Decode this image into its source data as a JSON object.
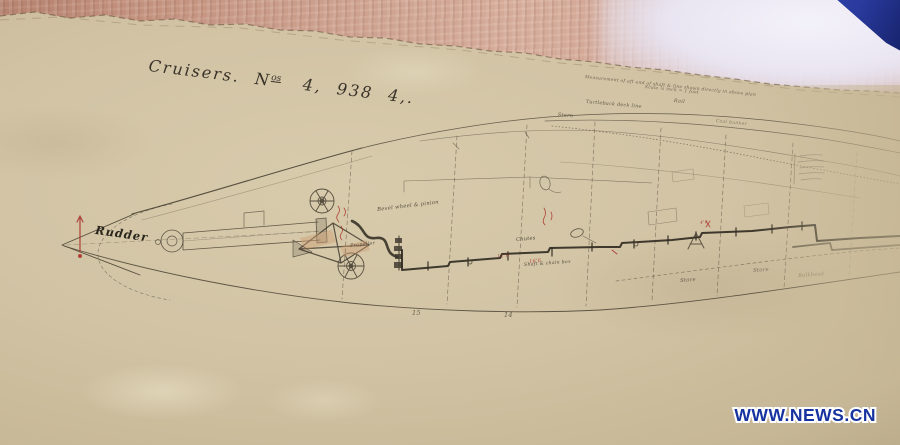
{
  "photo": {
    "watermark": "WWW.NEWS.CN"
  },
  "colors": {
    "paper": "#d1c3a4",
    "wood": "#cc9f8d",
    "ink": "#4a4234",
    "red_ink": "#a8352c",
    "watermark_blue": "#1733a0"
  },
  "plan": {
    "title": {
      "part1": "Cruisers.",
      "no_prefix": "N",
      "no_sup": "os",
      "part2": "4, 938 4,."
    },
    "annotations": [
      {
        "name": "rudder-label",
        "text": "Rudder",
        "x": 96,
        "y": 225,
        "size": 11.5,
        "rot": 8,
        "color": "#211d16",
        "weight": 700,
        "opacity": 0.95,
        "ls": 1
      },
      {
        "name": "bevel-wheel-label",
        "text": "Bevel wheel & pinion",
        "x": 377,
        "y": 208,
        "size": 5.2,
        "rot": -7,
        "color": "#463e30",
        "opacity": 0.9
      },
      {
        "name": "propeller-label",
        "text": "Propeller",
        "x": 350,
        "y": 245,
        "size": 4.8,
        "rot": -6,
        "color": "#463e30",
        "opacity": 0.85
      },
      {
        "name": "margin-note-line-1",
        "text": "Measurement of aft end of shaft & line shown directly in above plan",
        "x": 585,
        "y": 76,
        "size": 4.4,
        "rot": 6,
        "color": "#54493a",
        "opacity": 0.8
      },
      {
        "name": "margin-note-line-2",
        "text": "Scale ¼ inch = 1 foot",
        "x": 645,
        "y": 86,
        "size": 4.4,
        "rot": 6,
        "color": "#54493a",
        "opacity": 0.8
      },
      {
        "name": "stern-label",
        "text": "Stern",
        "x": 558,
        "y": 113,
        "size": 5,
        "rot": 5,
        "color": "#4a4234",
        "opacity": 0.85
      },
      {
        "name": "turtleback-label",
        "text": "Turtleback deck line",
        "x": 586,
        "y": 101,
        "size": 4.8,
        "rot": 5,
        "color": "#4a4234",
        "opacity": 0.85
      },
      {
        "name": "rail-label",
        "text": "Rail",
        "x": 674,
        "y": 99,
        "size": 5,
        "rot": 6,
        "color": "#4a4234",
        "opacity": 0.8
      },
      {
        "name": "coal-bunker-label",
        "text": "Coal bunker",
        "x": 716,
        "y": 120,
        "size": 4.5,
        "rot": 6,
        "color": "#4a4234",
        "opacity": 0.55
      },
      {
        "name": "chutes-label",
        "text": "Chutes",
        "x": 516,
        "y": 238,
        "size": 5,
        "rot": -5,
        "color": "#3c352a",
        "opacity": 0.9
      },
      {
        "name": "chain-box-label",
        "text": "Shaft & chain box",
        "x": 524,
        "y": 264,
        "size": 4.6,
        "rot": -4,
        "color": "#3c352a",
        "opacity": 0.85
      },
      {
        "name": "store-label-1",
        "text": "Store",
        "x": 680,
        "y": 279,
        "size": 5.2,
        "rot": -4,
        "color": "#4a4234",
        "opacity": 0.8
      },
      {
        "name": "store-label-2",
        "text": "Store",
        "x": 753,
        "y": 269,
        "size": 5.2,
        "rot": -4,
        "color": "#4a4234",
        "opacity": 0.65
      },
      {
        "name": "bulkhead-label",
        "text": "Bulkhead",
        "x": 798,
        "y": 274,
        "size": 5,
        "rot": -4,
        "color": "#4a4234",
        "opacity": 0.5
      },
      {
        "name": "station-number-15",
        "text": "15",
        "x": 412,
        "y": 310,
        "size": 6.5,
        "rot": 0,
        "color": "#4a4234",
        "opacity": 0.8
      },
      {
        "name": "station-number-14",
        "text": "14",
        "x": 504,
        "y": 312,
        "size": 6.5,
        "rot": 0,
        "color": "#4a4234",
        "opacity": 0.8
      },
      {
        "name": "red-dimension-1",
        "text": "11'6",
        "x": 497,
        "y": 255,
        "size": 5,
        "rot": -6,
        "color": "#a8352c",
        "opacity": 0.85
      },
      {
        "name": "red-dimension-2",
        "text": "16'6",
        "x": 529,
        "y": 260,
        "size": 5,
        "rot": -6,
        "color": "#a8352c",
        "opacity": 0.85
      },
      {
        "name": "red-dimension-3",
        "text": "4'6",
        "x": 700,
        "y": 222,
        "size": 4.5,
        "rot": -6,
        "color": "#a8352c",
        "opacity": 0.8
      }
    ]
  }
}
